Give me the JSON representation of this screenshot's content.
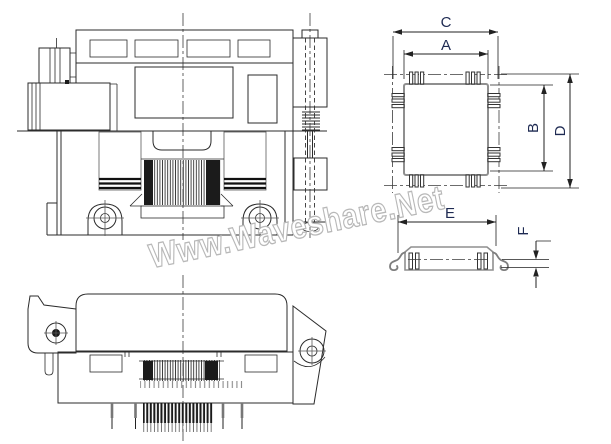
{
  "watermark": {
    "text": "Www.Waveshare.Net"
  },
  "drawing": {
    "dimension_labels": {
      "C": "C",
      "A": "A",
      "B": "B",
      "D": "D",
      "E": "E",
      "F": "F"
    }
  },
  "colors": {
    "background": "#ffffff",
    "line": "#2b2b2b",
    "package_outline": "#8f8f8f",
    "dimension_text": "#1e2a52",
    "watermark_stroke": "#b8b8b8",
    "watermark_fill": "#ffffff"
  }
}
